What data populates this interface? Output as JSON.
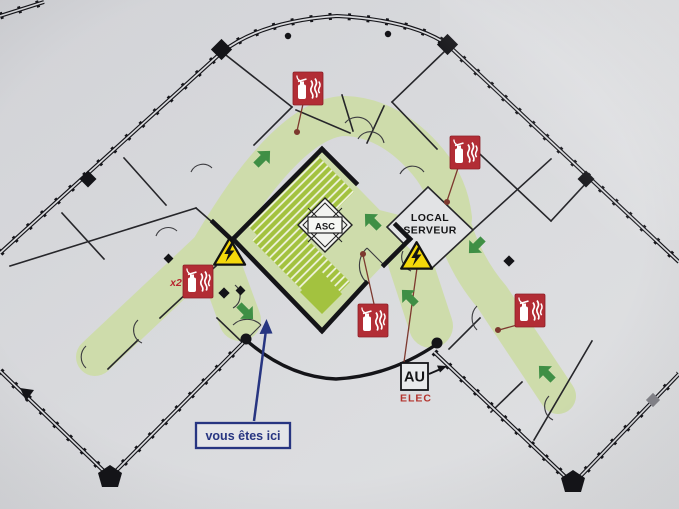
{
  "meta": {
    "kind": "evacuation-floor-plan-photo",
    "language": "fr"
  },
  "labels": {
    "server_room_line1": "LOCAL",
    "server_room_line2": "SERVEUR",
    "elevator": "ASC",
    "breaker": "AU",
    "breaker_sub": "ELEC",
    "extinguisher_count": "x2",
    "you_are_here": "vous êtes ici"
  },
  "icons": {
    "fire-extinguisher-icon": {
      "count": 5,
      "color": "#b22d35",
      "glyph": "white extinguisher and flames on red square"
    },
    "electrical-hazard-icon": {
      "count": 2,
      "color": "#f4d80a",
      "glyph": "black lightning bolt in yellow triangle"
    },
    "evacuation-arrow-icon": {
      "count": 6,
      "color": "#3f8f45",
      "glyph": "green block arrow"
    },
    "you-are-here-arrow-icon": {
      "count": 1,
      "color": "#273581",
      "glyph": "long blue arrow"
    }
  },
  "colors": {
    "paper": "#d8d9dc",
    "route_green": "#cedcab",
    "stair_green": "#a3c23f",
    "wall": "#17171b",
    "hazard_yellow": "#f4d80a",
    "extinguisher_red": "#b22d35",
    "arrow_green": "#3f8f45",
    "blue": "#273581",
    "elec_red": "#b3342e",
    "leader_brown": "#7d392f"
  }
}
